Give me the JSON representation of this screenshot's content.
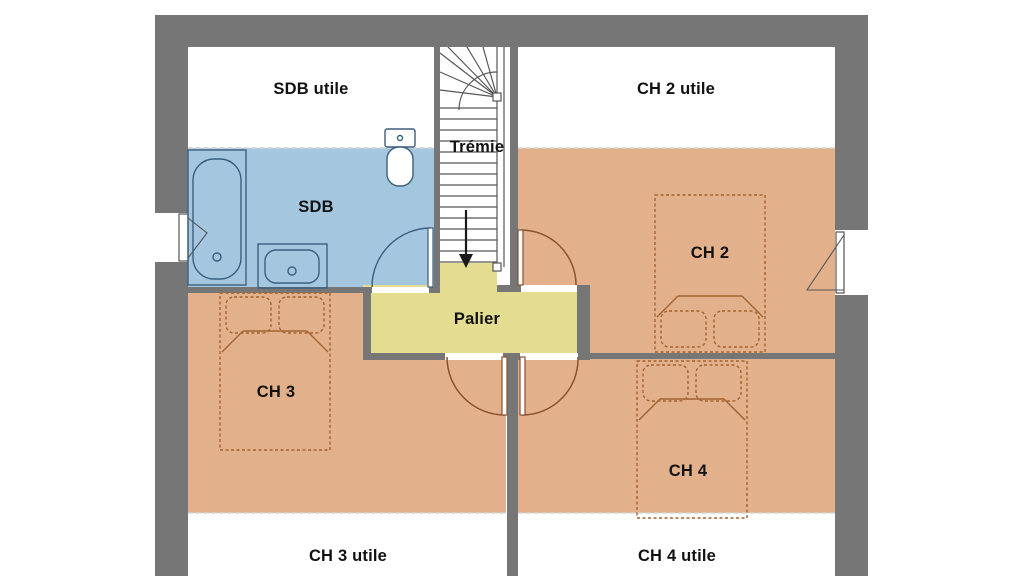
{
  "floor_plan": {
    "rooms": {
      "sdb_utile": {
        "label": "SDB utile",
        "floor_color": "#ffffff"
      },
      "ch2_utile": {
        "label": "CH 2 utile",
        "floor_color": "#ffffff"
      },
      "tremie": {
        "label": "Trémie",
        "floor_color": "#ffffff"
      },
      "sdb": {
        "label": "SDB",
        "floor_color": "#a4c6df"
      },
      "ch2": {
        "label": "CH 2",
        "floor_color": "#e2b18b"
      },
      "palier": {
        "label": "Palier",
        "floor_color": "#e4dc90"
      },
      "ch3": {
        "label": "CH 3",
        "floor_color": "#e2b18b"
      },
      "ch4": {
        "label": "CH 4",
        "floor_color": "#e2b18b"
      },
      "ch3_utile": {
        "label": "CH 3 utile",
        "floor_color": "#ffffff"
      },
      "ch4_utile": {
        "label": "CH 4 utile",
        "floor_color": "#ffffff"
      }
    },
    "colors": {
      "wall": "#767676",
      "bathroom_floor": "#a4c6df",
      "bedroom_floor": "#e2b18b",
      "landing_floor": "#e4dc90",
      "bathroom_fixture_outline": "#3a5f7e",
      "furniture_outline": "#a2622f",
      "door_outline": "#8a5030",
      "stair_outline": "#565656",
      "label_text": "#111111"
    },
    "symbols": {
      "fixtures": [
        "bathtub",
        "washbasin",
        "toilet"
      ],
      "furniture": [
        "double-bed-ch2",
        "double-bed-ch3",
        "double-bed-ch4"
      ],
      "stair_direction": "down"
    }
  }
}
